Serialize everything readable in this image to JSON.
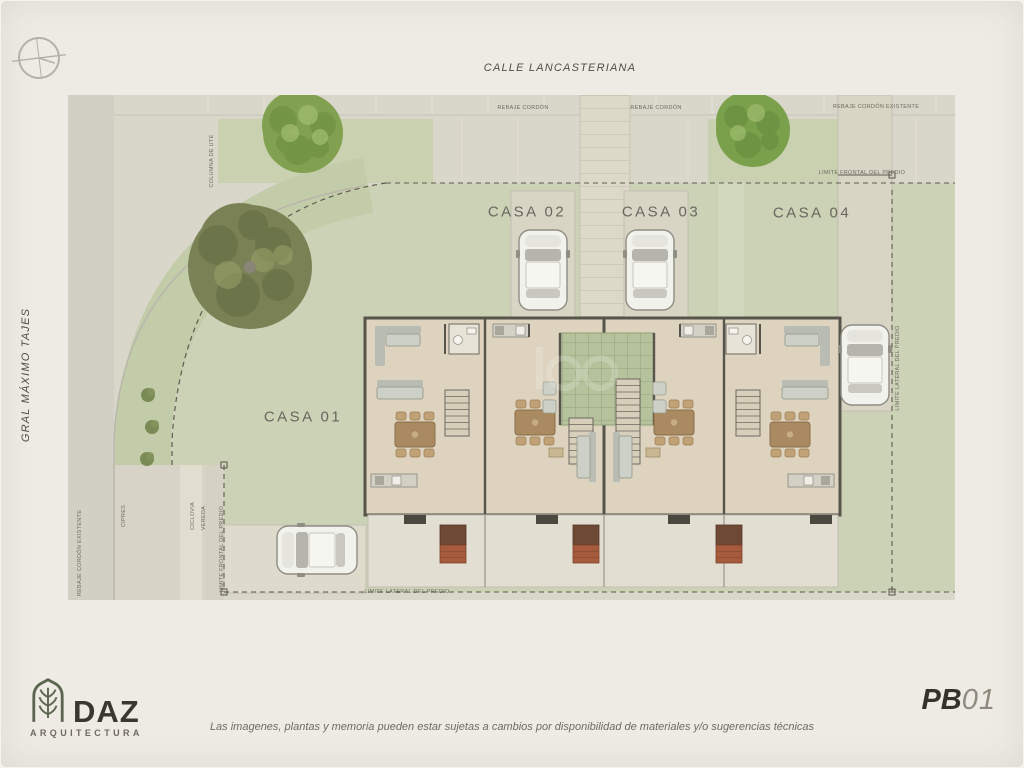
{
  "sheet": {
    "streets": {
      "top": "CALLE LANCASTERIANA",
      "left": "GRAL MÁXIMO TAJES"
    },
    "houses": [
      {
        "id": "casa-01",
        "label": "CASA 01",
        "x": 303,
        "y": 417
      },
      {
        "id": "casa-02",
        "label": "CASA 02",
        "x": 527,
        "y": 212
      },
      {
        "id": "casa-03",
        "label": "CASA 03",
        "x": 661,
        "y": 212
      },
      {
        "id": "casa-04",
        "label": "CASA 04",
        "x": 812,
        "y": 213
      }
    ],
    "annotations": [
      {
        "text": "REBAJE CORDÓN",
        "x": 523,
        "y": 108,
        "rot": 0
      },
      {
        "text": "REBAJE CORDÓN",
        "x": 656,
        "y": 108,
        "rot": 0
      },
      {
        "text": "REBAJE CORDÓN EXISTENTE",
        "x": 876,
        "y": 107,
        "rot": 0
      },
      {
        "text": "LIMITE FRONTAL DEL PREDIO",
        "x": 862,
        "y": 173,
        "rot": 0
      },
      {
        "text": "LIMITE LATERAL DEL PREDIO",
        "x": 898,
        "y": 368,
        "rot": -90
      },
      {
        "text": "REBAJE CORDÓN EXISTENTE",
        "x": 80,
        "y": 553,
        "rot": -90
      },
      {
        "text": "CIPRES",
        "x": 124,
        "y": 516,
        "rot": -90
      },
      {
        "text": "CICLOVIA",
        "x": 193,
        "y": 516,
        "rot": -90
      },
      {
        "text": "VEREDA",
        "x": 204,
        "y": 518,
        "rot": -90
      },
      {
        "text": "LIMITE FRONTAL DEL PREDIO",
        "x": 222,
        "y": 549,
        "rot": -90
      },
      {
        "text": "COLUMNA DE UTE",
        "x": 212,
        "y": 161,
        "rot": -90
      },
      {
        "text": "LIMITE LATERAL DEL PREDIO",
        "x": 407,
        "y": 592,
        "rot": 0
      }
    ],
    "icons": {
      "compass": "north-compass-icon",
      "logo": "arch-leaf-icon"
    },
    "footer": {
      "brand": "DAZ",
      "brand_sub": "ARQUITECTURA",
      "disclaimer": "Las imagenes, plantas y memoria pueden estar sujetas a cambios por disponibilidad de materiales y/o sugerencias técnicas",
      "sheet_code_prefix": "PB",
      "sheet_code_number": "01"
    },
    "colors": {
      "page": "#edebe3",
      "sidewalk": "#d9d6ca",
      "road": "#d2d0c4",
      "lawn": "#cbd2b6",
      "court": "#b5c29c",
      "floor": "#ddd3bf",
      "wall": "#57544b",
      "tree": "#81a150",
      "tree_olive": "#7a8155",
      "brand": "#3a372f",
      "label": "#6a675f"
    }
  }
}
